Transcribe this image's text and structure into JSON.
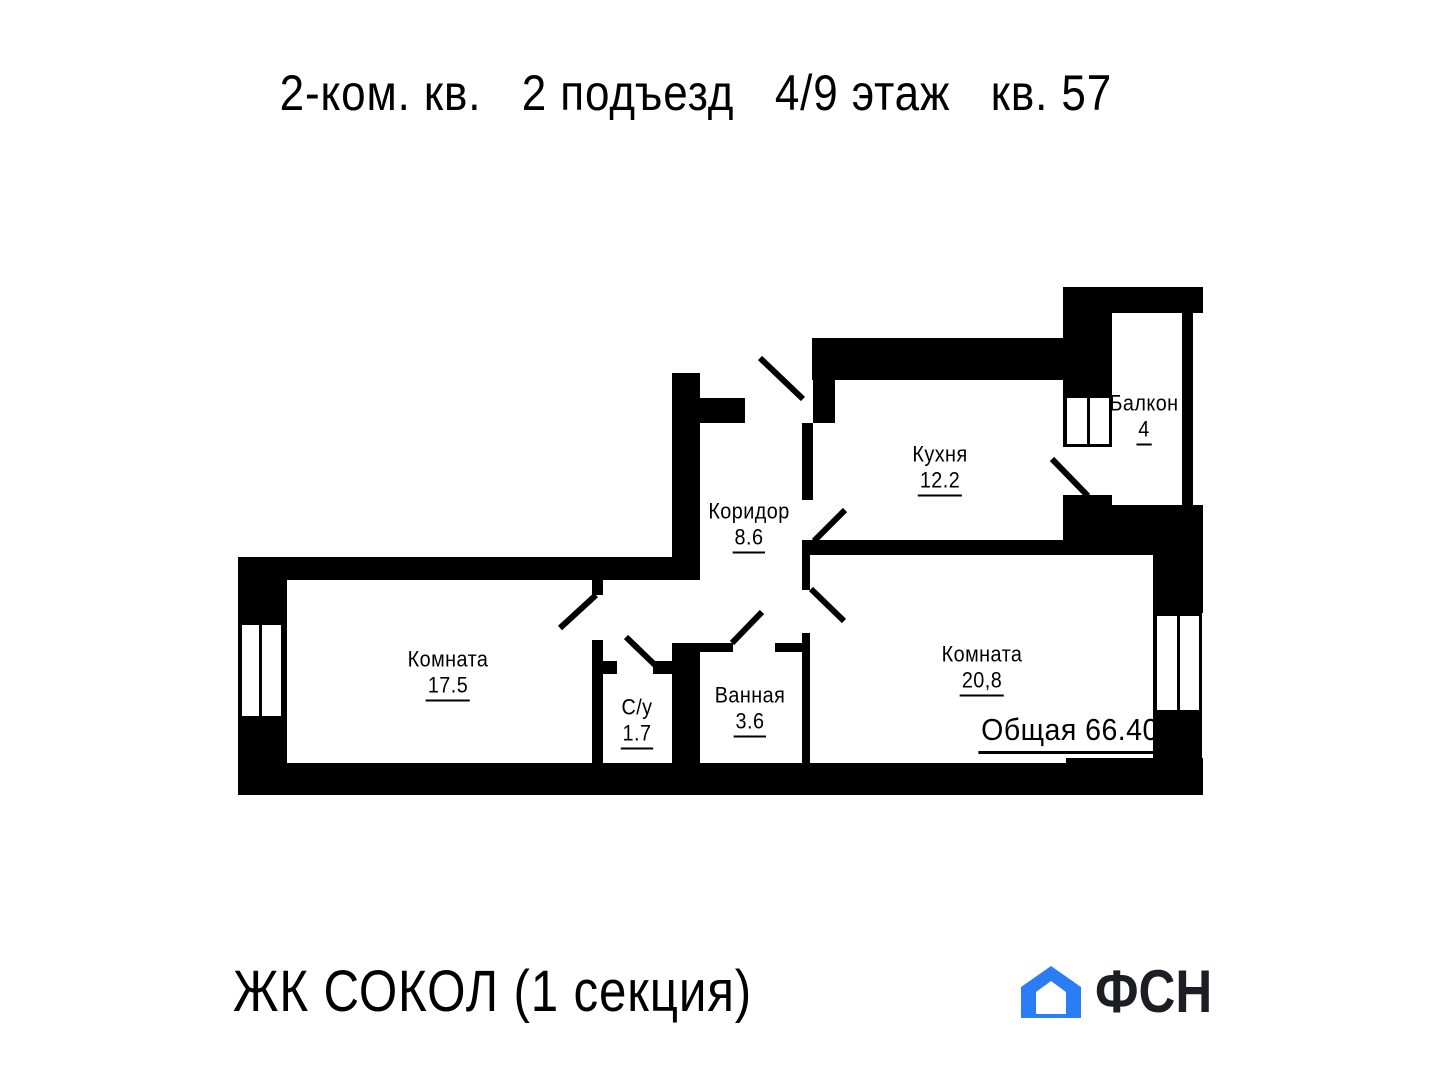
{
  "header": {
    "title_parts": [
      "2-ком. кв.",
      "2 подъезд",
      "4/9 этаж",
      "кв. 57"
    ]
  },
  "plan": {
    "rooms": [
      {
        "id": "kitchen",
        "name": "Кухня",
        "area": "12.2"
      },
      {
        "id": "balcony",
        "name": "Балкон",
        "area": "4"
      },
      {
        "id": "corridor",
        "name": "Коридор",
        "area": "8.6"
      },
      {
        "id": "room-1",
        "name": "Комната",
        "area": "17.5"
      },
      {
        "id": "wc",
        "name": "С/у",
        "area": "1.7"
      },
      {
        "id": "bathroom",
        "name": "Ванная",
        "area": "3.6"
      },
      {
        "id": "room-2",
        "name": "Комната",
        "area": "20,8"
      }
    ],
    "total": "Общая 66.40"
  },
  "footer": {
    "project": "ЖК СОКОЛ (1 секция)",
    "brand": "ФСН"
  },
  "colors": {
    "walls": "#000000",
    "logo_blue": "#2b7df5",
    "brand_text": "#1b1f24"
  }
}
